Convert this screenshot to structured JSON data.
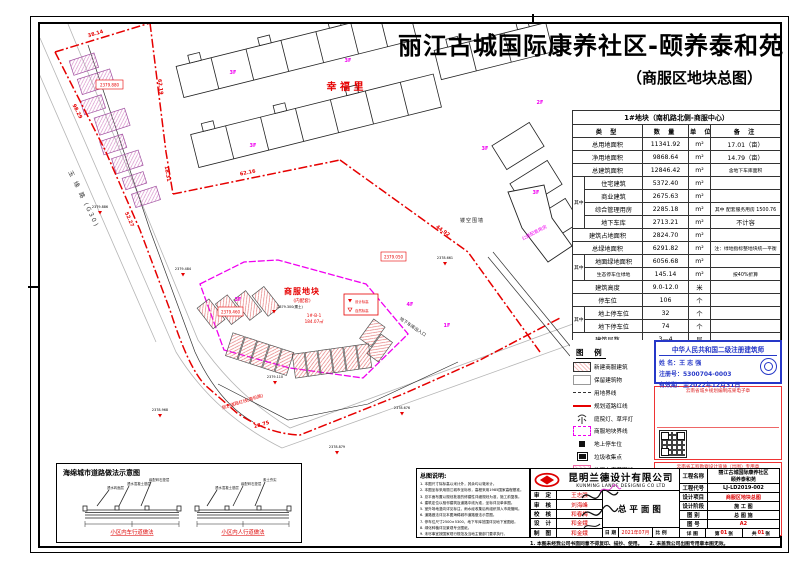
{
  "title": {
    "line1": "丽江古城国际康养社区-颐养泰和苑",
    "line2": "（商服区地块总图）"
  },
  "plan": {
    "road_left": "玉 缘 路 (G30)",
    "road_bottom": "规划道路红线(南机路)",
    "xingfuli": "幸 福 里",
    "plot_name": "商服地块",
    "plot_sub": "(内配套)",
    "unit_no": "1#-B-1",
    "unit_area": "184.07㎡",
    "fence": "镂空围墙",
    "gongjian": "公建配套用房",
    "garage_entry": "地下车库出入口",
    "marker_design": "设计标高",
    "marker_natural": "自然标高",
    "dims": {
      "a": "38.14",
      "b": "62.19",
      "c": "18.31",
      "d": "62.16",
      "e": "44.92",
      "f": "98.29",
      "g": "52.27",
      "h": "28.75"
    },
    "elevs": {
      "e1": "2379.886",
      "e2": "2379.300(覆土)",
      "e3": "2379.110",
      "e4": "2378.968",
      "e5": "2378.879",
      "e6": "2378.676",
      "e7": "2378.661",
      "e8": "2379.484"
    },
    "boxed": {
      "b1": "2379.880",
      "b2": "2379.460",
      "b3": "2379.050"
    },
    "floors": {
      "f1": "1F",
      "f2": "2F",
      "f3": "3F",
      "f4": "4F"
    }
  },
  "table": {
    "title": "1#地块（南机路北侧-商服中心）",
    "col_type": "类  型",
    "col_qty": "数  量",
    "col_unit": "单  位",
    "col_remark": "备  注",
    "qizhong": "其中",
    "rows": [
      {
        "name": "总用地面积",
        "qty": "11341.92",
        "unit": "m²",
        "remark": "17.01（亩）"
      },
      {
        "name": "净用地面积",
        "qty": "9868.64",
        "unit": "m²",
        "remark": "14.79（亩）"
      },
      {
        "name": "总建筑面积",
        "qty": "12846.42",
        "unit": "m²",
        "remark": "含地下车库面积"
      },
      {
        "name": "住宅建筑",
        "qty": "5372.40",
        "unit": "m²",
        "remark": ""
      },
      {
        "name": "商业建筑",
        "qty": "2675.63",
        "unit": "m²",
        "remark": ""
      },
      {
        "name": "综合管理用房",
        "qty": "2285.18",
        "unit": "m²",
        "remark": "其中 配套服务用房 1500.76"
      },
      {
        "name": "地下车库",
        "qty": "2713.21",
        "unit": "m²",
        "remark": "不计容"
      },
      {
        "name": "建筑占地面积",
        "qty": "2824.70",
        "unit": "m²",
        "remark": ""
      },
      {
        "name": "总绿地面积",
        "qty": "6291.82",
        "unit": "m²",
        "remark": "注：绿地指标整地块统一平衡"
      },
      {
        "name": "地面绿地面积",
        "qty": "6056.68",
        "unit": "m²",
        "remark": ""
      },
      {
        "name": "生态停车位绿地",
        "qty": "145.14",
        "unit": "m²",
        "remark": "按40%折算"
      },
      {
        "name": "建筑高度",
        "qty": "9.0-12.0",
        "unit": "米",
        "remark": ""
      },
      {
        "name": "停车位",
        "qty": "106",
        "unit": "个",
        "remark": ""
      },
      {
        "name": "地上停车位",
        "qty": "32",
        "unit": "个",
        "remark": ""
      },
      {
        "name": "地下停车位",
        "qty": "74",
        "unit": "个",
        "remark": ""
      },
      {
        "name": "建筑层数",
        "qty": "3—4",
        "unit": "层",
        "remark": ""
      }
    ]
  },
  "legend": {
    "title": "图 例",
    "items": [
      {
        "label": "新建商服建筑"
      },
      {
        "label": "保留建筑物"
      },
      {
        "label": "用地界线"
      },
      {
        "label": "规划道路红线"
      },
      {
        "label": "庭院灯、草坪灯"
      },
      {
        "label": "商服地块界线"
      },
      {
        "label": "地上停车位"
      },
      {
        "label": "垃圾收集点"
      },
      {
        "label": "地下车库范围线"
      }
    ]
  },
  "stamps": {
    "architect": {
      "title": "中华人民共和国二级注册建筑师",
      "name_line": "姓  名：王 志 强",
      "reg_line": "注册号：5300704-0003",
      "valid_line": "有效期：至2022年12月31日"
    },
    "red1": {
      "title": "云南省城乡规划编制成果电子章",
      "lines": [
        "单位名称：昆明兰德设计有限公司",
        "资质等级：乙级",
        "证书编号：A2530057",
        "有效日期：2023年10月31日",
        "发证机关：云南省自然资源厅",
        "此章仅用于规划成果电子备案"
      ]
    },
    "red2": {
      "title": "云南省工程勘察设计资质（出图）专用章",
      "lines": [
        "单位名称：昆明兰德设计有限公司",
        "资质类别：建筑行业（建筑工程）",
        "证书编号：A153005746",
        "有效日期：2023年06月30日",
        "云南省住房和城乡建设厅监制",
        "本电子章与实体印章具有同等效力"
      ]
    }
  },
  "notes": {
    "title": "总图说明:",
    "lines": [
      "1. 本图尺寸除标高以米计外，其余均以毫米计。",
      "2. 本图坐标采用丽江城市坐标系，高程采用1985国家高程基准。",
      "3. 总平面布置以规划批准的修建性详细规划为准，施工前复核。",
      "4. 建筑定位以相邻建筑及道路中线为准，坐标详见单体图。",
      "5. 室外场地竖向详见标注，雨水经收集后有组织排入市政管网。",
      "6. 道路做法详见本图海绵城市道路做法示意图。",
      "7. 停车位尺寸2500×5300，地下车库范围详见地下室图纸。",
      "8. 绿化种植详见景观专业图纸。",
      "9. 未尽事宜按国家现行规范及当地主管部门要求执行。"
    ]
  },
  "sponge": {
    "title": "海绵城市道路做法示意图",
    "cap1": "小区内车行道做法",
    "cap2": "小区内人行道做法",
    "layers": [
      "透水砖面层",
      "透水混凝土基层",
      "级配碎石垫层",
      "素土夯实"
    ]
  },
  "titleblock": {
    "company_cn": "昆明兰德设计有限公司",
    "company_en": "KUNMING LANDE DESIGNIG CO LTD",
    "roles": [
      {
        "label": "审 定",
        "name": "王志强"
      },
      {
        "label": "审 核",
        "name": "刘海峰"
      },
      {
        "label": "校 核",
        "name": "和春梅"
      },
      {
        "label": "设 计",
        "name": "和金娥"
      },
      {
        "label": "制 图",
        "name": "和金娥"
      }
    ],
    "drawing_name": "总平面图",
    "date_label": "日 期",
    "date": "2021年07月",
    "scale_label": "比 例",
    "project_name_label": "工程名称",
    "project_name1": "丽江古城国际康养社区",
    "project_name2": "颐养泰和苑",
    "code_label": "工程代号",
    "code": "LJ-LD2019-002",
    "item_label": "设计项目",
    "item": "商服区地块总图",
    "stage_label": "设计阶段",
    "stage": "施 工 图",
    "cat_label": "图  别",
    "cat": "总 图 施",
    "num_label": "图  号",
    "num": "A2",
    "sheet": {
      "label": "详 图",
      "no_pre": "第",
      "no": "01",
      "no_suf": "张",
      "tot_pre": "共",
      "tot": "01",
      "tot_suf": "张"
    },
    "note": "1. 本图未经我公司书面同意不得复印、描抄、使用。　　2. 未盖我公司出图专用章本图无效。"
  }
}
